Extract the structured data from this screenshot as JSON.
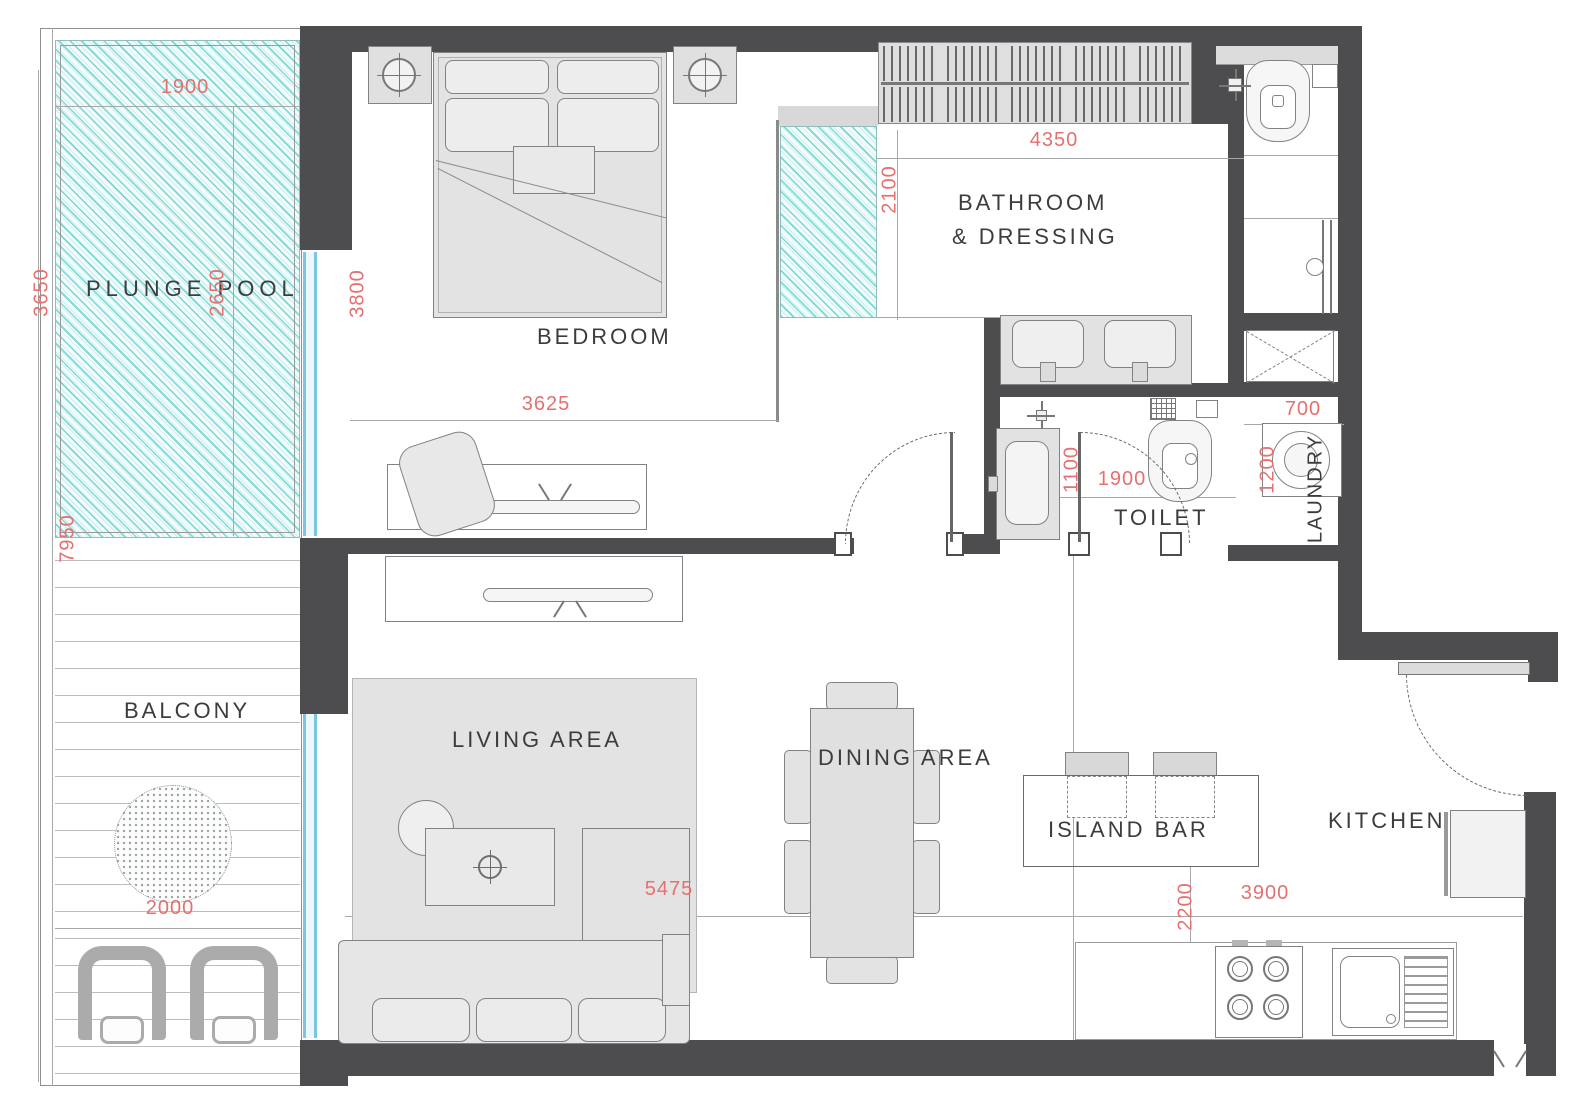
{
  "title": "apartment-floor-plan",
  "rooms": {
    "plunge_pool": "PLUNGE  POOL",
    "bedroom": "BEDROOM",
    "bathroom_line1": "BATHROOM",
    "bathroom_line2": "&  DRESSING",
    "toilet": "TOILET",
    "laundry": "LAUNDRY",
    "balcony": "BALCONY",
    "living": "LIVING  AREA",
    "dining": "DINING  AREA",
    "island_bar": "ISLAND  BAR",
    "kitchen": "KITCHEN"
  },
  "dims": {
    "pool_width": "1900",
    "pool_side_left": "3650",
    "pool_side_inner": "2650",
    "balcony_total": "7950",
    "balcony_width": "2000",
    "bedroom_depth": "3800",
    "bedroom_width": "3625",
    "bathroom_width": "4350",
    "bathroom_depth": "2100",
    "toilet_width": "1900",
    "toilet_depth": "1100",
    "laundry_width": "700",
    "laundry_depth": "1200",
    "living_width": "5475",
    "kitchen_width": "3900",
    "kitchen_depth": "2200"
  },
  "colors": {
    "wall": "#4d4d4f",
    "dimension": "#e57070",
    "pool_hatch": "#28bebe",
    "glass": "#7cc7e0",
    "label": "#3c3c3c"
  }
}
